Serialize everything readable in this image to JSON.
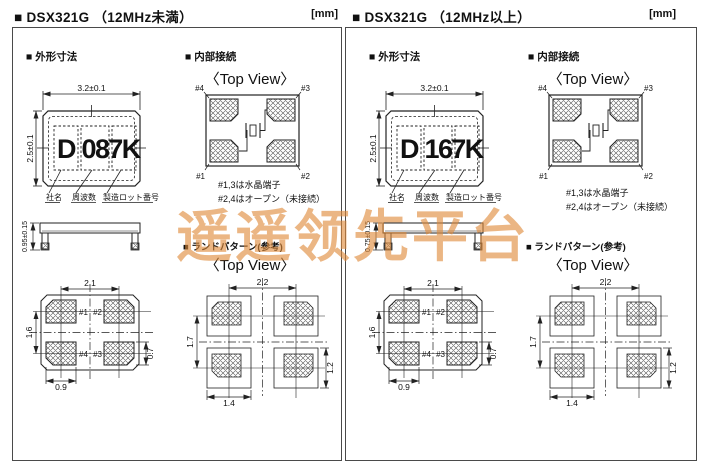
{
  "watermark": {
    "text": "遥遥领先平台",
    "color": "#df8a3a"
  },
  "colors": {
    "line": "#222222",
    "accent_orange": "#df8a3a"
  },
  "panels": [
    {
      "title": "■ DSX321G （12MHz未満）",
      "unit": "[mm]",
      "outline": {
        "heading": "■ 外形寸法",
        "dim_width": "3.2±0.1",
        "dim_height": "2.5±0.1",
        "dim_thickness": "0.95±0.15",
        "marking": [
          "D",
          "08",
          "7K"
        ],
        "marking_labels": [
          "社名",
          "周波数",
          "製造ロット番号"
        ]
      },
      "bottom_view": {
        "dim_pitch_x": "2.1",
        "dim_pitch_y": "1.6",
        "dim_pad_w": "0.9",
        "dim_pad_h": "0.7",
        "pin_tl": "#1",
        "pin_tr": "#2",
        "pin_bl": "#4",
        "pin_br": "#3"
      },
      "internal": {
        "heading": "■ 内部接続",
        "view": "〈Top View〉",
        "pin_tl": "#4",
        "pin_tr": "#3",
        "pin_bl": "#1",
        "pin_br": "#2",
        "note1": "#1,3は水晶端子",
        "note2": "#2,4はオープン（未接続）"
      },
      "land": {
        "heading": "■ ランドパターン(参考)",
        "view": "〈Top View〉",
        "dim_pitch_x": "2.2",
        "dim_pitch_y": "1.7",
        "dim_pad_w": "1.4",
        "dim_pad_h": "1.2"
      }
    },
    {
      "title": "■ DSX321G （12MHz以上）",
      "unit": "[mm]",
      "outline": {
        "heading": "■ 外形寸法",
        "dim_width": "3.2±0.1",
        "dim_height": "2.5±0.1",
        "dim_thickness": "0.75±0.15",
        "marking": [
          "D",
          "16",
          "7K"
        ],
        "marking_labels": [
          "社名",
          "周波数",
          "製造ロット番号"
        ]
      },
      "bottom_view": {
        "dim_pitch_x": "2.1",
        "dim_pitch_y": "1.6",
        "dim_pad_w": "0.9",
        "dim_pad_h": "0.7",
        "pin_tl": "#1",
        "pin_tr": "#2",
        "pin_bl": "#4",
        "pin_br": "#3"
      },
      "internal": {
        "heading": "■ 内部接続",
        "view": "〈Top View〉",
        "pin_tl": "#4",
        "pin_tr": "#3",
        "pin_bl": "#1",
        "pin_br": "#2",
        "note1": "#1,3は水晶端子",
        "note2": "#2,4はオープン（未接続）"
      },
      "land": {
        "heading": "■ ランドパターン(参考)",
        "view": "〈Top View〉",
        "dim_pitch_x": "2.2",
        "dim_pitch_y": "1.7",
        "dim_pad_w": "1.4",
        "dim_pad_h": "1.2"
      }
    }
  ]
}
